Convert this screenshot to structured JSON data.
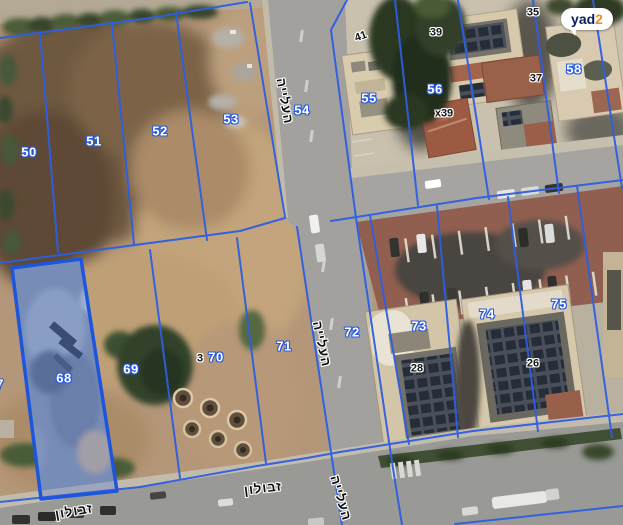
{
  "logo": {
    "brand_yad": "yad",
    "brand_2": "2"
  },
  "map": {
    "selected_parcel": "68",
    "parcel_labels": [
      "50",
      "51",
      "52",
      "53",
      "54",
      "55",
      "56",
      "58",
      "68",
      "69",
      "70",
      "71",
      "72",
      "73",
      "74",
      "75",
      "7"
    ],
    "house_numbers": [
      "41",
      "39",
      "35",
      "x39",
      "37",
      "3",
      "28",
      "26"
    ],
    "streets": {
      "haaliyah": "העלייה",
      "zevulun": "זבולון"
    },
    "colors": {
      "parcel_line": "#2e5ee2",
      "selected_parcel_fill": "rgba(59,103,228,0.27)",
      "selected_parcel_stroke": "#1d55dd",
      "parcel_label_text": "#ffffff",
      "parcel_label_outline": "#2a5ce0",
      "house_number_text": "#141414",
      "logo_yad": "#0a1e5c",
      "logo_2": "#f68b1f"
    }
  }
}
